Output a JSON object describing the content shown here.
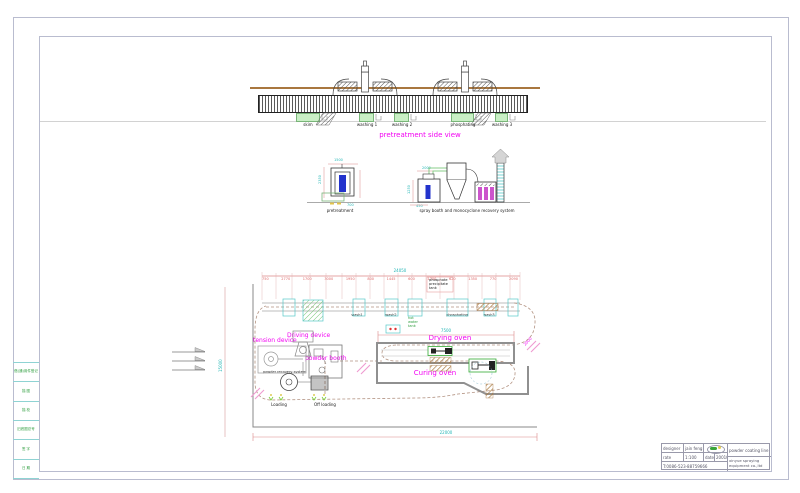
{
  "left_strip": {
    "cells": [
      "借(通)用件登记",
      "描 图",
      "描 校",
      "旧底图总号",
      "签 字",
      "日 期"
    ]
  },
  "side_view": {
    "title": "pretreatment side view",
    "tank_labels": [
      "skim",
      "washing 1",
      "washing 2",
      "phosphating",
      "washing 3"
    ]
  },
  "elevations": {
    "pretreatment_label": "pretreatment",
    "spray_label": "spray booth and monocyclone recovery system",
    "pre_dims": {
      "top": "1500",
      "left": "2350",
      "bottom": "700"
    },
    "spray_dims": {
      "top": "2000",
      "left": "1250",
      "bottom": "450"
    }
  },
  "plan": {
    "dims": {
      "overall_top": "24050",
      "overall_bottom": "22000",
      "left_height": "15000",
      "oven_length": "7500",
      "right_slope": "2000"
    },
    "segment_dims": [
      "750",
      "2770",
      "1700",
      "3000",
      "1950",
      "800",
      "1445",
      "600",
      "1700",
      "620",
      "1350",
      "770",
      "2090"
    ],
    "labels": {
      "phos_lines": [
        "phosphate",
        "precipitate",
        "tank"
      ],
      "hot_water_lines": [
        "hot",
        "water",
        "tank"
      ],
      "wash1": "wash1",
      "wash2": "wash2",
      "phosphating": "phosphating",
      "wash3": "wash3",
      "tension_device": "tension device",
      "driving_device": "Driving device",
      "powder_booth": "powder booth",
      "powder_recovery": "powder recovery system",
      "drying_oven": "Drying oven",
      "curing_oven": "Curing oven",
      "loading": "Loading",
      "offloading": "Off loading"
    }
  },
  "title_block": {
    "designer_label": "designer",
    "designer": "jain feng",
    "rate_label": "rate",
    "rate": "1:100",
    "date_label": "date",
    "date": "200107",
    "phone": "T:0086-523-88759666",
    "product": "powder coating line",
    "company": "xinyue spraying equipment co.,ltd"
  }
}
